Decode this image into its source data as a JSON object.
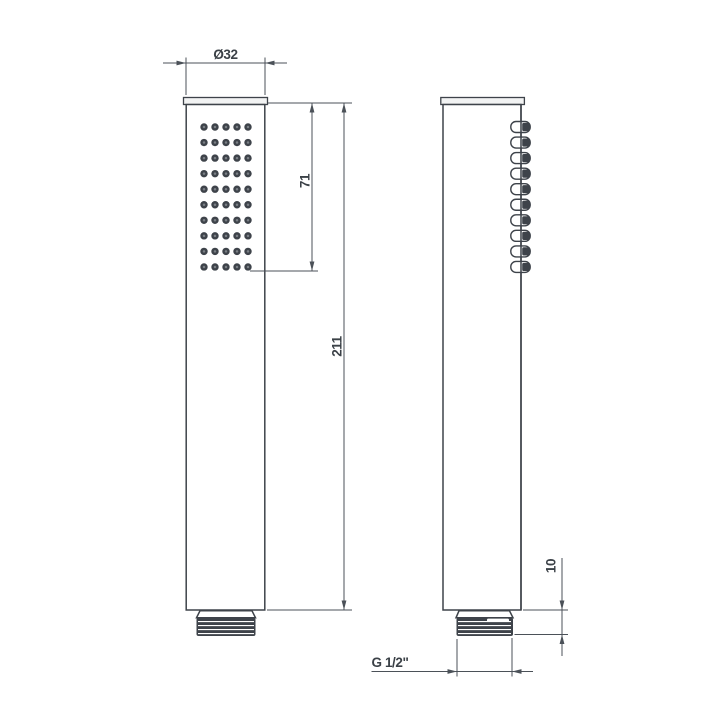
{
  "drawing": {
    "dimensions": {
      "diameter": "Ø32",
      "spray_face_length": "71",
      "total_length": "211",
      "thread_length": "10",
      "thread_size": "G 1/2\""
    },
    "front_view": {
      "spray_hole_rows": 10,
      "spray_hole_cols": 5
    },
    "side_view": {
      "nozzle_count": 10
    },
    "colors": {
      "outline": "#3e434a",
      "dimension_line": "#4b5158",
      "text": "#3b4147",
      "paper": "#ffffff"
    }
  }
}
